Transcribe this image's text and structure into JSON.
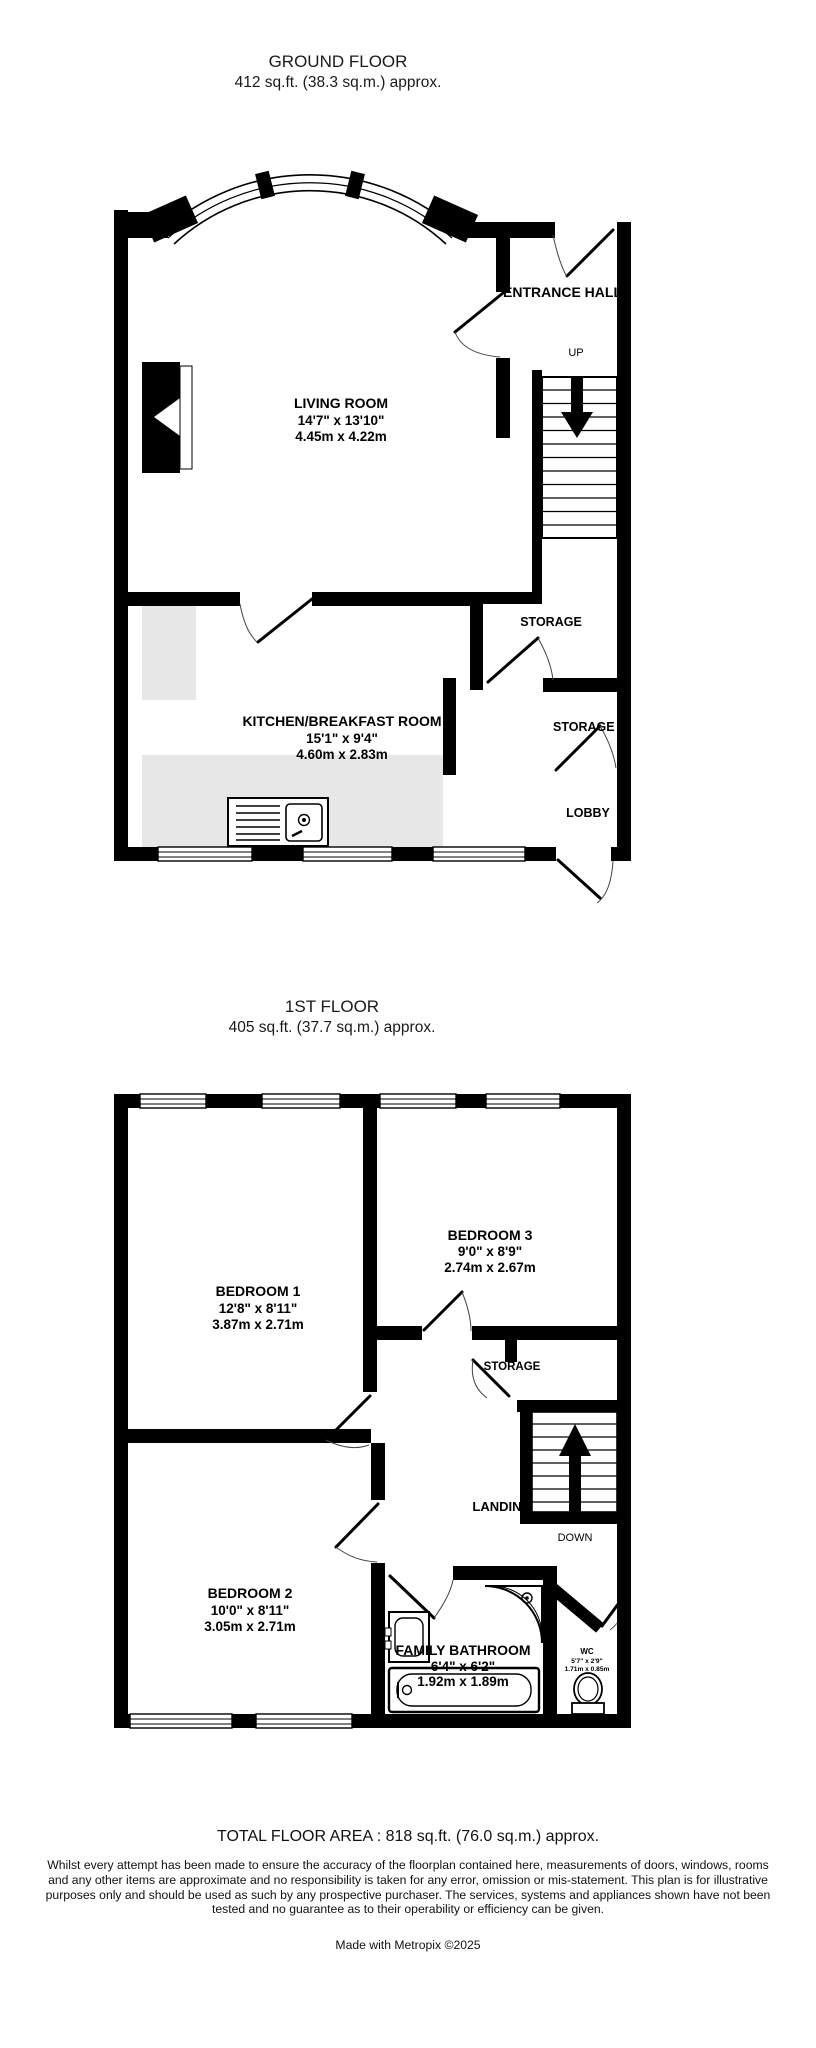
{
  "colors": {
    "wall": "#000000",
    "counter": "#e7e7e7",
    "text": "#000000",
    "background": "#ffffff"
  },
  "gf": {
    "title": "GROUND FLOOR",
    "subtitle": "412 sq.ft. (38.3 sq.m.) approx.",
    "rooms": {
      "living": {
        "name": "LIVING ROOM",
        "imp": "14'7\"  x 13'10\"",
        "met": "4.45m  x 4.22m"
      },
      "kitchen": {
        "name": "KITCHEN/BREAKFAST ROOM",
        "imp": "15'1\"  x 9'4\"",
        "met": "4.60m  x 2.83m"
      }
    },
    "labels": {
      "entrance": "ENTRANCE HALL",
      "up": "UP",
      "storage1": "STORAGE",
      "storage2": "STORAGE",
      "lobby": "LOBBY"
    }
  },
  "ff": {
    "title": "1ST FLOOR",
    "subtitle": "405 sq.ft. (37.7 sq.m.) approx.",
    "rooms": {
      "b1": {
        "name": "BEDROOM 1",
        "imp": "12'8\"  x 8'11\"",
        "met": "3.87m  x 2.71m"
      },
      "b3": {
        "name": "BEDROOM 3",
        "imp": "9'0\"  x 8'9\"",
        "met": "2.74m  x 2.67m"
      },
      "b2": {
        "name": "BEDROOM 2",
        "imp": "10'0\"  x 8'11\"",
        "met": "3.05m  x 2.71m"
      },
      "bath": {
        "name": "FAMILY BATHROOM",
        "imp": "6'4\"  x 6'2\"",
        "met": "1.92m  x 1.89m"
      },
      "wc": {
        "name": "WC",
        "imp": "5'7\"  x 2'9\"",
        "met": "1.71m  x 0.85m"
      }
    },
    "labels": {
      "storage": "STORAGE",
      "landing": "LANDING",
      "down": "DOWN"
    }
  },
  "footer": {
    "total": "TOTAL FLOOR AREA : 818 sq.ft. (76.0 sq.m.) approx.",
    "disclaimer": "Whilst every attempt has been made to ensure the accuracy of the floorplan contained here, measurements of doors, windows, rooms and any other items are approximate and no responsibility is taken for any error, omission or mis-statement. This plan is for illustrative purposes only and should be used as such by any prospective purchaser. The services, systems and appliances shown have not been tested and no guarantee as to their operability or efficiency can be given.",
    "credit": "Made with Metropix ©2025"
  }
}
